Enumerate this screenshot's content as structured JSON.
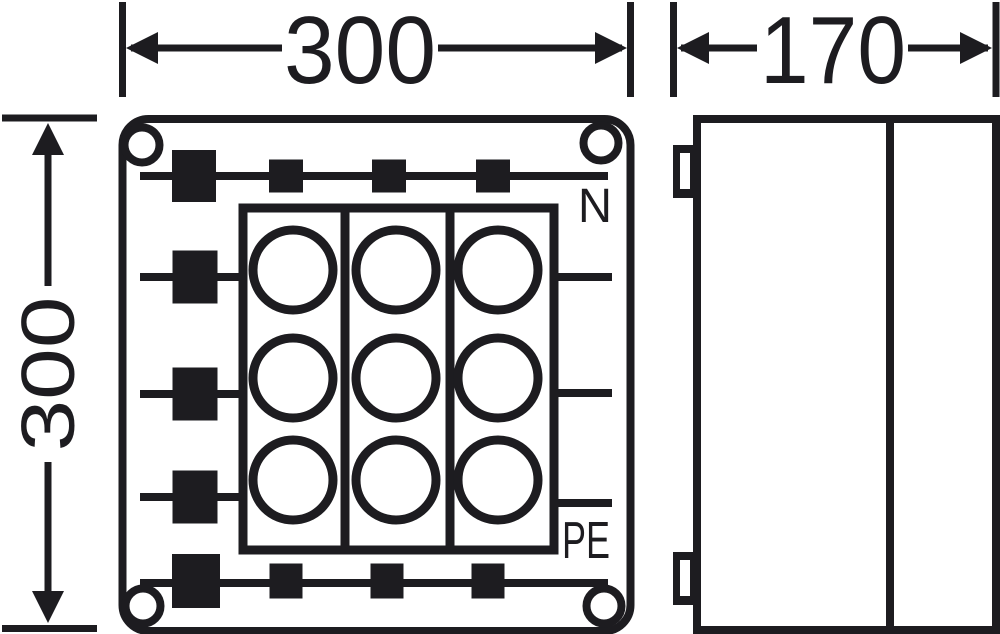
{
  "drawing": {
    "type": "enclosure-dimension-drawing",
    "dimensions": {
      "front_width": "300",
      "front_height": "300",
      "side_depth": "170"
    },
    "views": {
      "front": {
        "terminal_labels": {
          "top_rail": "N",
          "bottom_rail": "PE"
        },
        "gland_grid": {
          "columns": 3,
          "rows": 3
        },
        "corner_screws": 4,
        "top_rail_terminals": 4,
        "bottom_rail_terminals": 4,
        "side_feed_terminals": 3
      },
      "side": {
        "hinge_tabs": 2
      }
    },
    "colors": {
      "line": "#1d1c20",
      "background": "#ffffff"
    }
  }
}
